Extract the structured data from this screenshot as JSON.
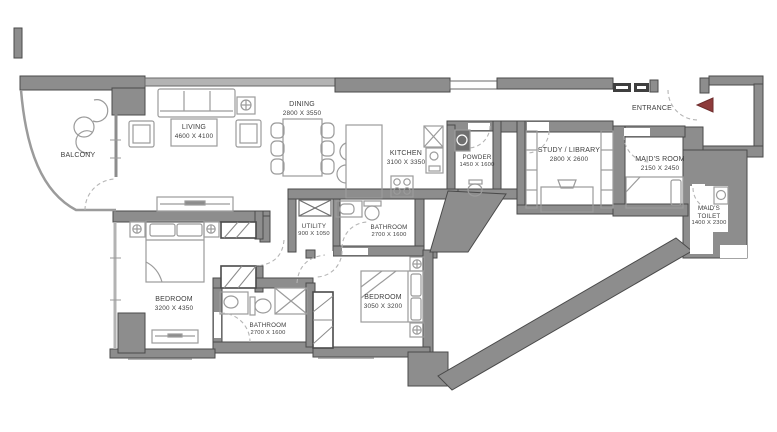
{
  "plan_title": "Apartment floor plan",
  "colors": {
    "wall": "#8d8d8d",
    "wall_edge": "#4a4a4a",
    "furniture_line": "#9b9b9b",
    "door_arc": "#b5b5b5",
    "text": "#3e3e3e",
    "entrance_arrow": "#8e3b3b",
    "window_symbol": "#3f3f3f"
  },
  "rooms": {
    "balcony": {
      "name": "BALCONY",
      "dims": ""
    },
    "living": {
      "name": "LIVING",
      "dims": "4600 X 4100"
    },
    "dining": {
      "name": "DINING",
      "dims": "2800 X 3550"
    },
    "kitchen": {
      "name": "KITCHEN",
      "dims": "3100 X 3350"
    },
    "powder": {
      "name": "POWDER",
      "dims": "1450 X 1600"
    },
    "study": {
      "name": "STUDY / LIBRARY",
      "dims": "2800 X 2600"
    },
    "entrance": {
      "name": "ENTRANCE",
      "dims": ""
    },
    "maids_room": {
      "name": "MAID'S ROOM",
      "dims": "2150 X 2450"
    },
    "maids_toilet": {
      "line1": "MAID'S",
      "line2": "TOILET",
      "dims": "1400 X 2300"
    },
    "utility": {
      "name": "UTILITY",
      "dims": "900 X 1050"
    },
    "bathroom_top": {
      "name": "BATHROOM",
      "dims": "2700 X 1600"
    },
    "bedroom_right": {
      "name": "BEDROOM",
      "dims": "3050 X 3200"
    },
    "bathroom_bottom": {
      "name": "BATHROOM",
      "dims": "2700 X 1600"
    },
    "bedroom_master": {
      "name": "BEDROOM",
      "dims": "3200 X 4350"
    }
  },
  "icons": {
    "entrance_arrow": "left-pointing-triangle"
  }
}
